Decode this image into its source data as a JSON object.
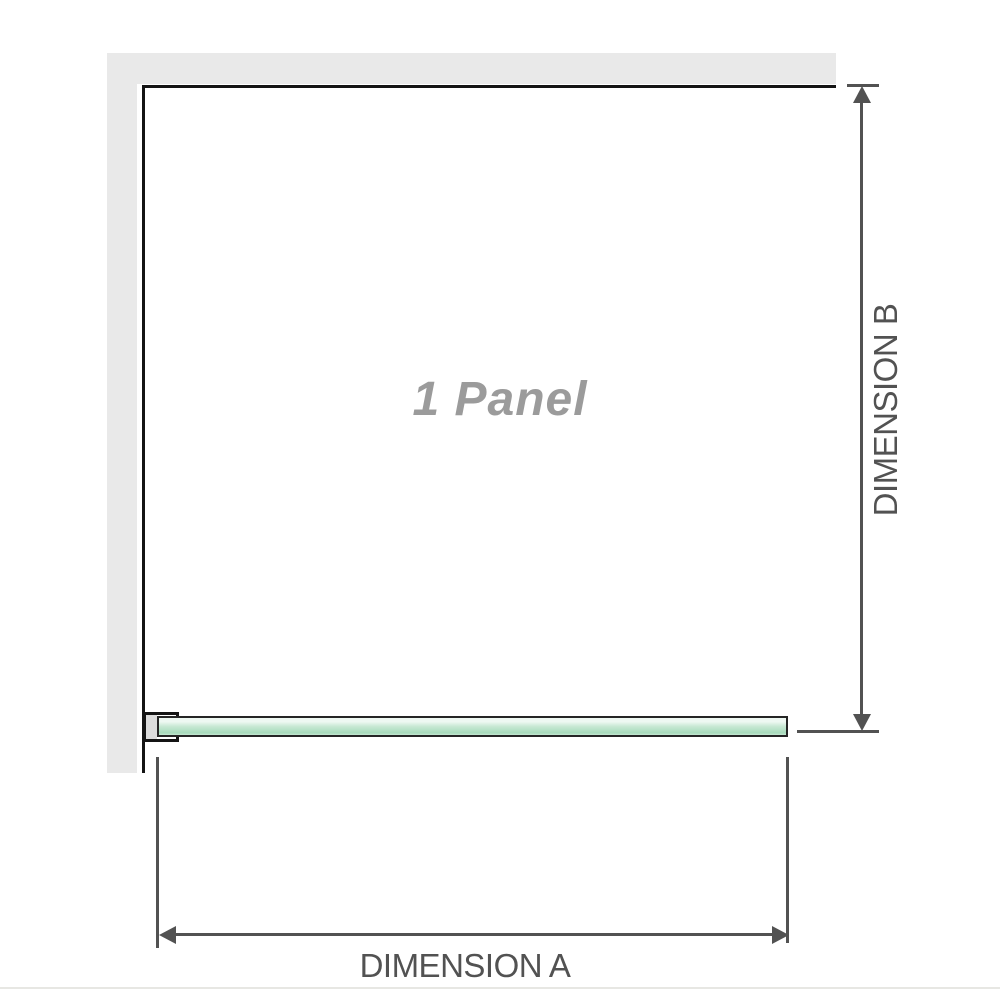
{
  "diagram": {
    "panel_label": "1 Panel",
    "dimension_a_label": "DIMENSION A",
    "dimension_b_label": "DIMENSION B"
  },
  "colors": {
    "wall": "#e9e9e9",
    "wall_edge": "#141414",
    "glass_border": "#252525",
    "glass_light": "#eef8f2",
    "glass_mid": "#c7e8d3",
    "glass_dark": "#a7dabb",
    "dimension": "#525252",
    "panel_text": "#9b9b9b",
    "bracket_fill": "#dcdcdc",
    "baseline": "#e7e7e3"
  }
}
